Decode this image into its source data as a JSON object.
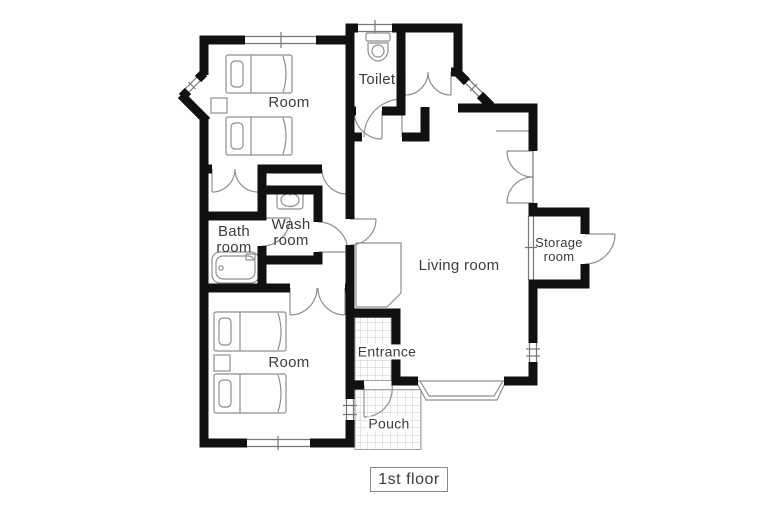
{
  "plan": {
    "floor_label": "1st floor",
    "rooms": {
      "room_top": {
        "label": "Room"
      },
      "toilet": {
        "label": "Toilet"
      },
      "bath": {
        "line1": "Bath",
        "line2": "room"
      },
      "wash": {
        "line1": "Wash",
        "line2": "room"
      },
      "living": {
        "label": "Living room"
      },
      "storage": {
        "line1": "Storage",
        "line2": "room"
      },
      "room_bottom": {
        "label": "Room"
      },
      "entrance": {
        "label": "Entrance"
      },
      "pouch": {
        "label": "Pouch"
      }
    },
    "fixtures": [
      "bed-icon",
      "nightstand-icon",
      "toilet-icon",
      "sink-icon",
      "bathtub-icon",
      "tile-floor",
      "bay-window",
      "door-swing",
      "window"
    ],
    "colors": {
      "wall": "#111111",
      "line": "#8f8f8f",
      "text": "#3c3c3c",
      "background": "#ffffff"
    }
  }
}
